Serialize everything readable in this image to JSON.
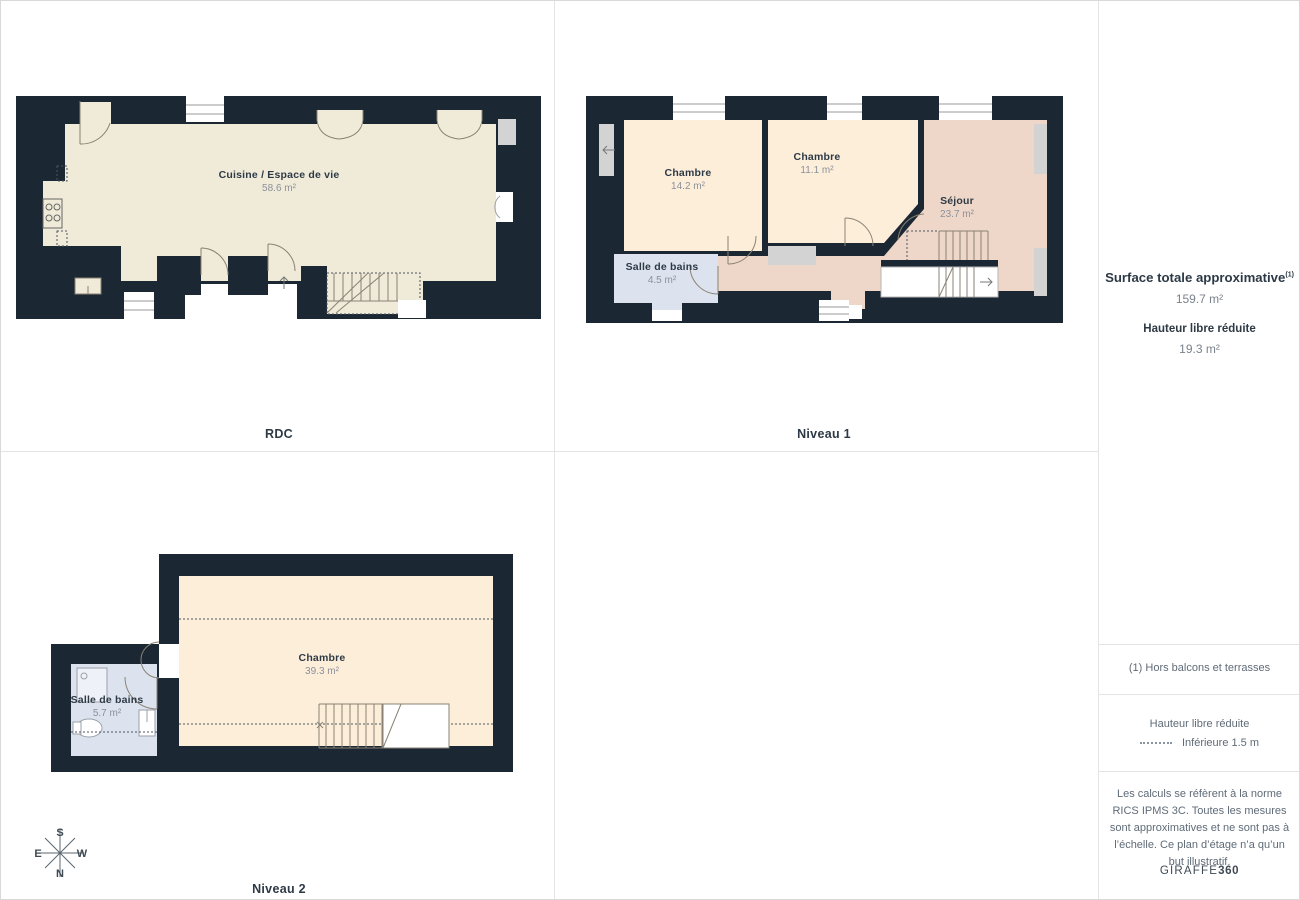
{
  "plans": {
    "rdc": {
      "title": "RDC",
      "rooms": [
        {
          "name": "Cuisine / Espace de vie",
          "area": "58.6 m²"
        }
      ]
    },
    "niveau1": {
      "title": "Niveau 1",
      "rooms": [
        {
          "name": "Chambre",
          "area": "14.2 m²"
        },
        {
          "name": "Chambre",
          "area": "11.1 m²"
        },
        {
          "name": "Séjour",
          "area": "23.7 m²"
        },
        {
          "name": "Salle de bains",
          "area": "4.5 m²"
        }
      ]
    },
    "niveau2": {
      "title": "Niveau 2",
      "rooms": [
        {
          "name": "Chambre",
          "area": "39.3 m²"
        },
        {
          "name": "Salle de bains",
          "area": "5.7 m²"
        }
      ]
    }
  },
  "compass": {
    "north": "N",
    "south": "S",
    "east": "E",
    "west": "W"
  },
  "sidebar": {
    "surface_label": "Surface totale approximative",
    "surface_footnote_marker": "(1)",
    "surface_value": "159.7 m²",
    "height_label": "Hauteur libre réduite",
    "height_value": "19.3 m²",
    "footnote": "(1) Hors balcons et terrasses",
    "legend_title": "Hauteur libre réduite",
    "legend_item": "Inférieure 1.5 m",
    "disclaimer": "Les calculs se réfèrent à la norme RICS IPMS 3C. Toutes les mesures sont approximatives et ne sont pas à l’échelle. Ce plan d’étage n’a qu’un but illustratif.",
    "brand_name": "GIRAFFE",
    "brand_suffix": "360"
  },
  "colors": {
    "wall": "#1b2733",
    "floor_cream": "#f0ebd9",
    "floor_peach": "#fdeeda",
    "floor_pink": "#eed7c9",
    "floor_blue": "#dde3ee",
    "ledge_gray": "#d3d3d3",
    "label_dark": "#2d3a46",
    "label_gray": "#8b919a",
    "sidebar_text": "#5f6b77",
    "grid_line": "#e4e4e4"
  }
}
